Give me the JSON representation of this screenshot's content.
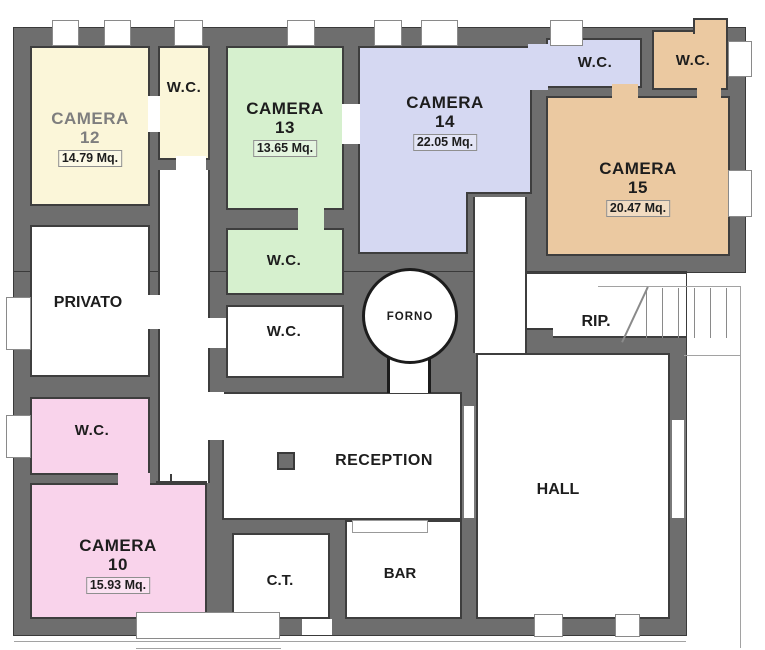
{
  "rooms": {
    "camera12": {
      "name": "CAMERA",
      "number": "12",
      "area": "14.79 Mq.",
      "color": "#FBF6D9"
    },
    "camera13": {
      "name": "CAMERA",
      "number": "13",
      "area": "13.65 Mq.",
      "color": "#D6F0CE"
    },
    "camera14": {
      "name": "CAMERA",
      "number": "14",
      "area": "22.05 Mq.",
      "color": "#D5D8F2"
    },
    "camera15": {
      "name": "CAMERA",
      "number": "15",
      "area": "20.47 Mq.",
      "color": "#EBC9A1"
    },
    "camera10": {
      "name": "CAMERA",
      "number": "10",
      "area": "15.93 Mq.",
      "color": "#F9D3EB"
    },
    "wc_camera12": {
      "label": "W.C."
    },
    "wc_camera13": {
      "label": "W.C."
    },
    "wc_corridor": {
      "label": "W.C."
    },
    "wc_camera14": {
      "label": "W.C."
    },
    "wc_camera15": {
      "label": "W.C."
    },
    "wc_camera10": {
      "label": "W.C."
    },
    "privato": {
      "label": "PRIVATO"
    },
    "forno": {
      "label": "FORNO"
    },
    "rip": {
      "label": "RIP."
    },
    "reception": {
      "label": "RECEPTION"
    },
    "hall": {
      "label": "HALL"
    },
    "ct": {
      "label": "C.T."
    },
    "bar": {
      "label": "BAR"
    }
  },
  "colors": {
    "wall": "#6E6E6E",
    "wall_edge": "#3A3A3A",
    "camera12_fill": "#FBF6D9",
    "camera13_fill": "#D6F0CE",
    "camera14_fill": "#D5D8F2",
    "camera15_fill": "#EBC9A1",
    "camera10_fill": "#F9D3EB",
    "service_fill": "#FFFFFF"
  },
  "features": {
    "stairs": "stairs with treads and diagonal cut line beside RIP.",
    "oven": "circular FORNO (wood oven) between CAMERA 14 and RIP.",
    "pillar": "square column in RECEPTION",
    "bar_counter": "counter rectangle at top of BAR"
  }
}
